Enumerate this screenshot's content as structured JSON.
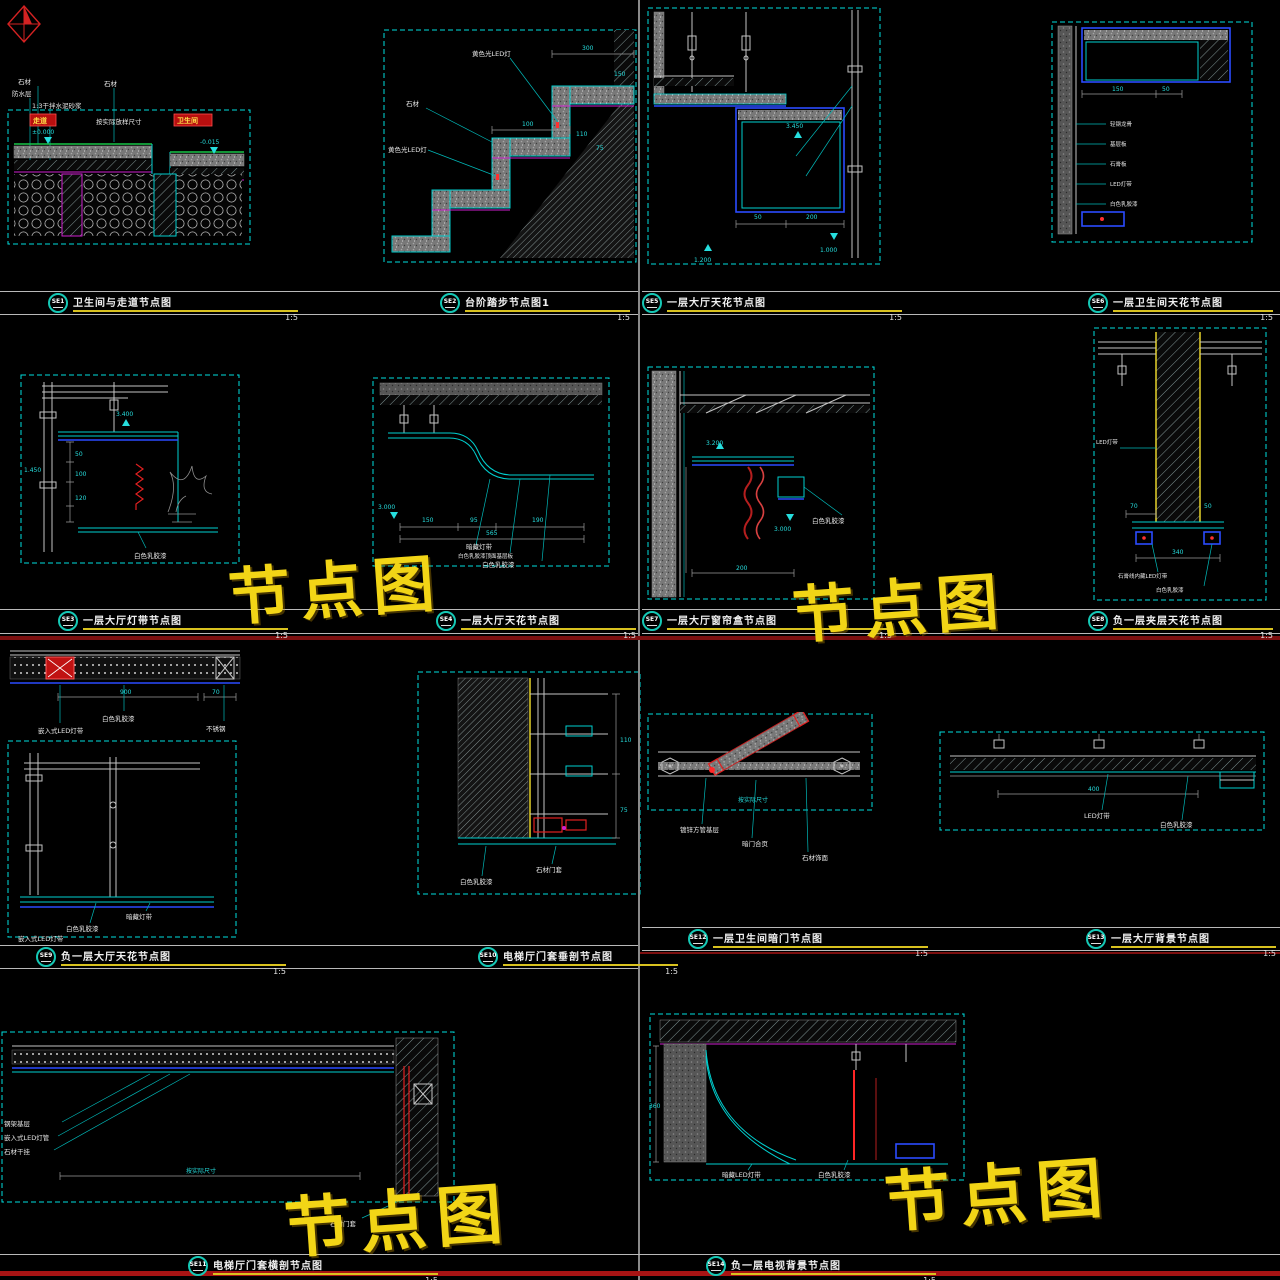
{
  "watermarks": [
    {
      "text": "节点图"
    },
    {
      "text": "节点图"
    },
    {
      "text": "节点图"
    },
    {
      "text": "节点图"
    }
  ],
  "titles": [
    {
      "id": "SE1",
      "label": "卫生间与走道节点图",
      "scale": "1:5"
    },
    {
      "id": "SE2",
      "label": "台阶踏步节点图1",
      "scale": "1:5"
    },
    {
      "id": "SE3",
      "label": "一层大厅灯带节点图",
      "scale": "1:5"
    },
    {
      "id": "SE4",
      "label": "一层大厅天花节点图",
      "scale": "1:5"
    },
    {
      "id": "SE5",
      "label": "一层大厅天花节点图",
      "scale": "1:5"
    },
    {
      "id": "SE6",
      "label": "一层卫生间天花节点图",
      "scale": "1:5"
    },
    {
      "id": "SE7",
      "label": "一层大厅窗帘盒节点图",
      "scale": "1:5"
    },
    {
      "id": "SE8",
      "label": "负一层夹层天花节点图",
      "scale": "1:5"
    },
    {
      "id": "SE9",
      "label": "负一层大厅天花节点图",
      "scale": "1:5"
    },
    {
      "id": "SE10",
      "label": "电梯厅门套垂剖节点图",
      "scale": "1:5"
    },
    {
      "id": "SE11",
      "label": "电梯厅门套横剖节点图",
      "scale": "1:5"
    },
    {
      "id": "SE12",
      "label": "一层卫生间暗门节点图",
      "scale": "1:5"
    },
    {
      "id": "SE13",
      "label": "一层大厅背景节点图",
      "scale": "1:5"
    },
    {
      "id": "SE14",
      "label": "负一层电视背景节点图",
      "scale": "1:5"
    }
  ],
  "drawings": {
    "se1": {
      "lbl_stone": "石材",
      "lbl_wp": "防水层",
      "lbl_mortar": "1:3干拌水泥砂浆",
      "lbl_stone2": "石材",
      "tag_corridor": "走道",
      "tag_bath": "卫生间",
      "lbl_fit": "按实际放样尺寸",
      "lv_zero": "±0.000",
      "lv_down": "-0.015"
    },
    "se2": {
      "lbl_led": "黄色光LED灯",
      "lbl_stone": "石材",
      "d300": "300",
      "d150": "150",
      "d110": "110",
      "d75": "75",
      "d100": "100"
    },
    "se3": {
      "lv": "3.400",
      "d1450": "1.450",
      "d50": "50",
      "d100": "100",
      "d120": "120",
      "lbl_paint": "白色乳胶漆"
    },
    "se4": {
      "lv": "3.000",
      "d150": "150",
      "d95": "95",
      "d190": "190",
      "d565": "565",
      "lbl_led": "暗藏灯带",
      "lbl_base": "白色乳胶漆顶面基层板",
      "lbl_paint": "白色乳胶漆"
    },
    "se5": {
      "lv1": "3.450",
      "lv2": "1.200",
      "lv3": "1.000",
      "d50": "50",
      "d200": "200"
    },
    "se6": {
      "d150": "150",
      "d50": "50",
      "n1": "轻钢龙骨",
      "n2": "基层板",
      "n3": "石膏板",
      "n4": "LED灯带",
      "n5": "白色乳胶漆"
    },
    "se7": {
      "lv1": "3.200",
      "lv2": "3.000",
      "d200": "200",
      "lbl_paint": "白色乳胶漆"
    },
    "se8": {
      "d70": "70",
      "d50": "50",
      "d340": "340",
      "lbl_gypsum": "石膏线内藏LED灯带",
      "lbl_paint": "白色乳胶漆",
      "lbl_led": "LED灯带"
    },
    "se9": {
      "d900": "900",
      "d70": "70",
      "lbl_led": "嵌入式LED灯带",
      "lbl_paint": "白色乳胶漆",
      "lbl_steel": "不锈钢",
      "lbl_hidden": "暗藏灯带"
    },
    "se10": {
      "d110": "110",
      "d75": "75",
      "lbl_frame": "石材门套",
      "lbl_paint": "白色乳胶漆"
    },
    "se11": {
      "lbl_steel": "钢架基层",
      "lbl_led": "嵌入式LED灯管",
      "lbl_stone": "石材干挂",
      "lbl_fit": "按实际尺寸",
      "lbl_frame": "石材门套"
    },
    "se12": {
      "lbl_fit": "按实际尺寸",
      "n1": "镀锌方管基层",
      "n2": "暗门合页",
      "n3": "石材饰面"
    },
    "se13": {
      "d400": "400",
      "lbl_led": "LED灯带",
      "lbl_paint": "白色乳胶漆"
    },
    "se14": {
      "d360": "360",
      "lbl_led": "暗藏LED灯带",
      "lbl_paint": "白色乳胶漆"
    }
  },
  "colors": {
    "bg": "#000000",
    "line_cyan": "#00cfcf",
    "line_blue": "#2b4bff",
    "accent_yellow": "#e6d22a",
    "accent_red": "#cc2222",
    "accent_magenta": "#d020d0",
    "watermark_yellow": "#f2d516",
    "bubble_teal": "#15c9b6"
  }
}
